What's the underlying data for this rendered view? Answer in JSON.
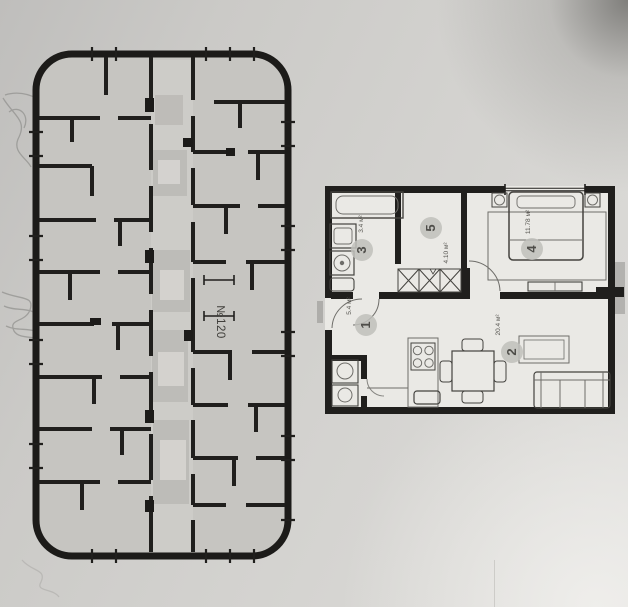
{
  "building_plan": {
    "unit_label": "№120"
  },
  "apartment_plan": {
    "rooms": [
      {
        "number": "1",
        "area": "5.4 м²"
      },
      {
        "number": "2",
        "area": "20.4 м²"
      },
      {
        "number": "3",
        "area": "3.4 м²"
      },
      {
        "number": "4",
        "area": "11.78 м²"
      },
      {
        "number": "5",
        "area": "4.10 м²"
      }
    ]
  },
  "colors": {
    "paper": "#d3d2cf",
    "wall": "#201f1d",
    "floor_plate_fill": "#c6c5c1",
    "apartment_fill": "#eae9e5",
    "pencil_marks": "#8b8a87",
    "room_badge": "#c0bfbb"
  }
}
